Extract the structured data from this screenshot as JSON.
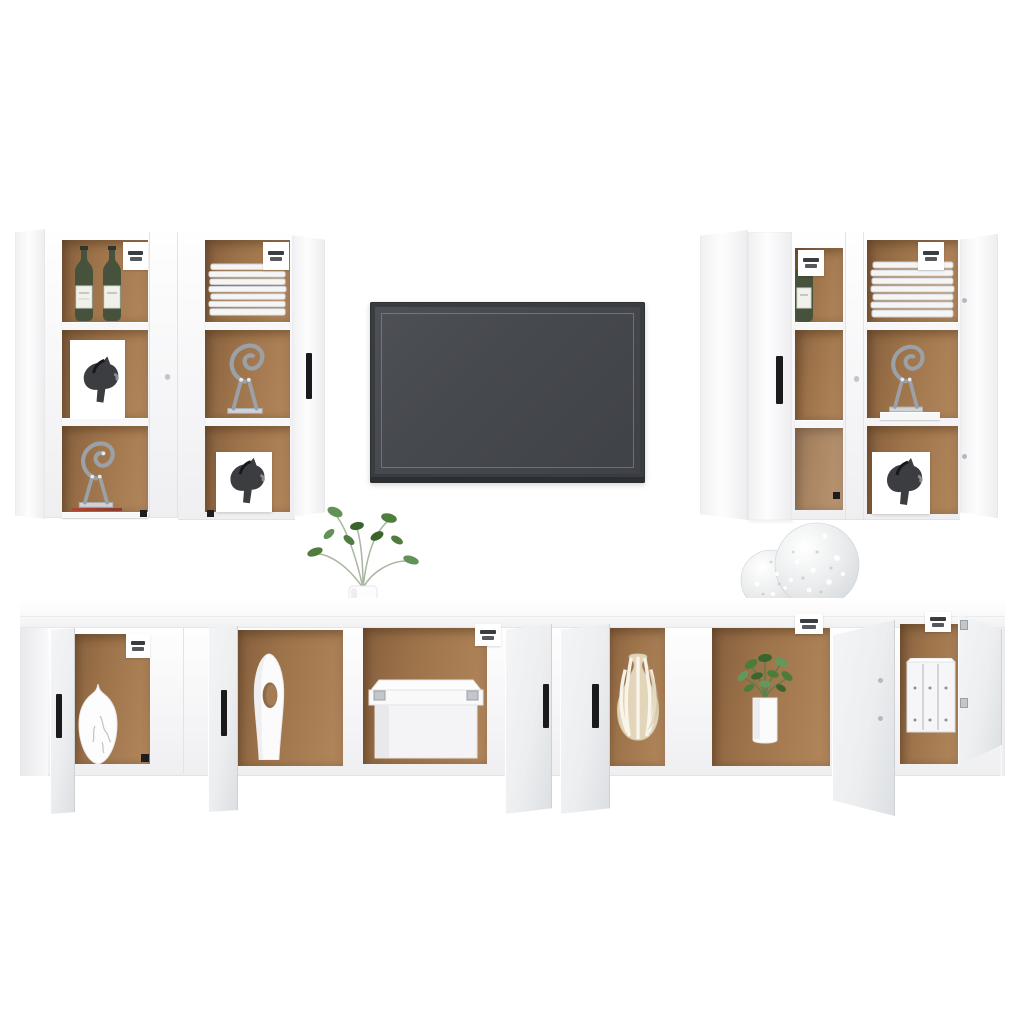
{
  "scene": {
    "type": "furniture-product-photo",
    "description": "8-piece white TV wall-unit set on a white studio background: four tall wall-hung cabinets with open doors flanking a wall-mounted dark gray TV, and a long low TV bench of four cabinets below with open doors revealing brown interiors styled with decor objects.",
    "labels": {
      "canvas": "Product photo of a white 8-piece TV cabinet wall set",
      "wall_cabinets_left": "Two tall white wall cabinets with open doors, left of the TV",
      "tv": "Wall-mounted flat-screen TV with dark gray screen",
      "wall_cabinets_right": "Two tall white wall cabinets with open doors, right of the TV",
      "bench": "Row of four low white TV cabinets with open doors and brown interiors",
      "plant_top": "Green sprigs in a white vase standing on the bench top",
      "spheres": "Two silver decorative openwork spheres on the bench top",
      "magazines": "White magazines lying flat on the bench top"
    },
    "items": [
      {
        "name": "wine-bottles",
        "location": "left wall cabinet, top shelf"
      },
      {
        "name": "plate-stack",
        "location": "left wall cabinet pair, right unit top shelf"
      },
      {
        "name": "wire-cat-sculpture",
        "location": "wall cabinets, middle and bottom shelves"
      },
      {
        "name": "horse-art-print",
        "location": "wall cabinets, lower shelves"
      },
      {
        "name": "wine-bottle",
        "location": "right wall cabinet, top shelf"
      },
      {
        "name": "marble-vase",
        "location": "bench, first open compartment"
      },
      {
        "name": "white-sculptural-vase",
        "location": "bench, second open compartment"
      },
      {
        "name": "white-storage-box",
        "location": "bench, third open compartment"
      },
      {
        "name": "striped-vase",
        "location": "bench, fourth open compartment"
      },
      {
        "name": "potted-plant",
        "location": "bench, fifth open compartment"
      },
      {
        "name": "white-binders",
        "location": "bench, last open compartment"
      }
    ],
    "colors": {
      "bg": "#ffffff",
      "panel_white": "#fbfbfc",
      "panel_edge": "#e3e3e5",
      "door_gray": "#eceef0",
      "door_gray_dark": "#dcdfe2",
      "interior_brown": "#9d734a",
      "interior_brown_dark": "#855f3d",
      "interior_brown_light": "#b3875c",
      "shelf_white": "#f7f7f8",
      "handle_black": "#1a1a1c",
      "tv_frame": "#393c40",
      "tv_screen": "#46494e",
      "tv_inner_line": "#94979a",
      "bottle_green": "#46523b",
      "plant_green": "#4e7d3d",
      "stripe_beige": "#e2d5ba",
      "sculpture_silver": "#9ba1a7",
      "sphere_silver": "#d5d8db",
      "paper_edge": "#dcdcdf"
    }
  }
}
